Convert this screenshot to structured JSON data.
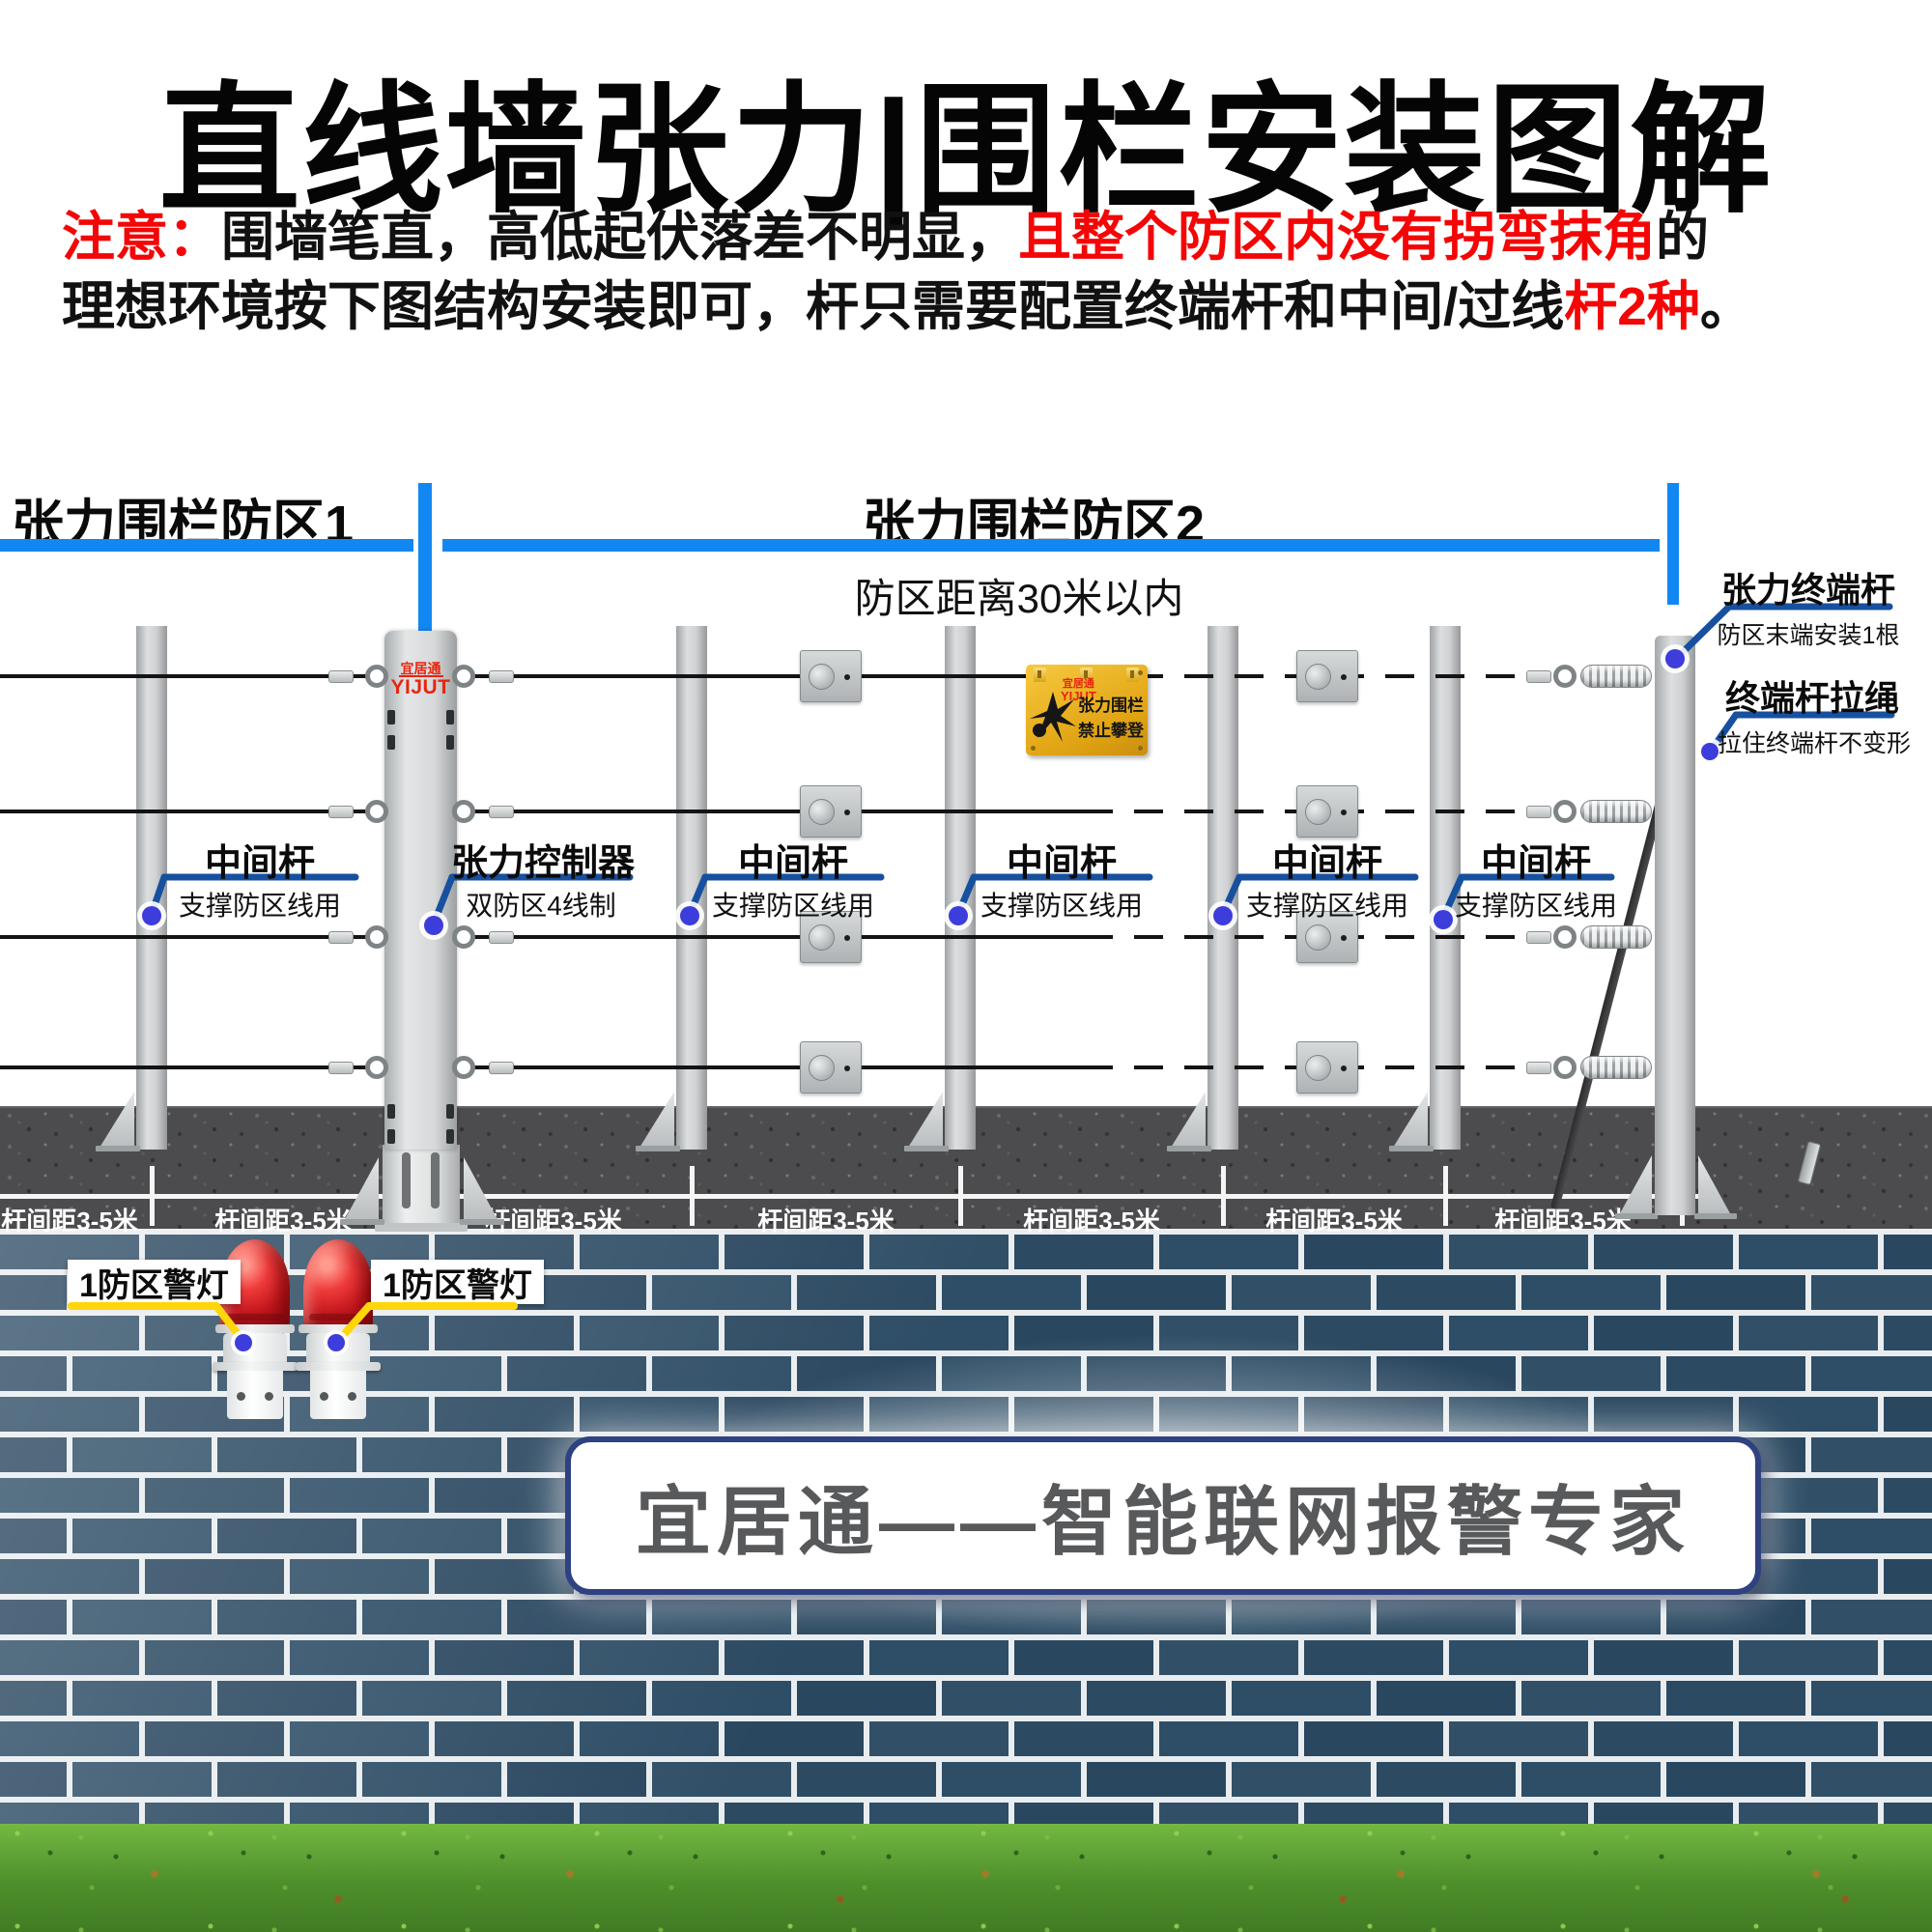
{
  "title": "直线墙张力|围栏安装图解",
  "note": {
    "prefix": "注意：",
    "l1_black1": "围墙笔直，高低起伏落差不明显，",
    "l1_red": "且整个防区内没有拐弯抹角",
    "l1_black2": "的",
    "l2_black1": "理想环境按下图结构安装即可，杆只需要配置终端杆和中间/过线",
    "l2_red": "杆2种",
    "l2_black2": "。"
  },
  "zones": {
    "zone1": "张力围栏防区1",
    "zone2": "张力围栏防区2",
    "distance": "防区距离30米以内"
  },
  "callouts": [
    {
      "title": "中间杆",
      "sub": "支撑防区线用"
    },
    {
      "title": "张力控制器",
      "sub": "双防区4线制"
    },
    {
      "title": "中间杆",
      "sub": "支撑防区线用"
    },
    {
      "title": "中间杆",
      "sub": "支撑防区线用"
    },
    {
      "title": "中间杆",
      "sub": "支撑防区线用"
    },
    {
      "title": "中间杆",
      "sub": "支撑防区线用"
    },
    {
      "title": "张力终端杆",
      "sub": "防区末端安装1根"
    },
    {
      "title": "终端杆拉绳",
      "sub": "拉住终端杆不变形"
    }
  ],
  "controller_logo": {
    "cn": "宜居通",
    "en": "YIJUT"
  },
  "sign": {
    "logo_cn": "宜居通",
    "logo_en": "YIJUT",
    "line1": "张力围栏",
    "line2": "禁止攀登"
  },
  "ground": {
    "labels": [
      "杆间距3-5米",
      "杆间距3-5米",
      "杆间距3-5米",
      "杆间距3-5米",
      "杆间距3-5米",
      "杆间距3-5米",
      "杆间距3-5米"
    ]
  },
  "lamps": {
    "labels": [
      "1防区警灯",
      "1防区警灯"
    ]
  },
  "banner": {
    "text": "宜居通——智能联网报警专家"
  },
  "colors": {
    "zone_bar": "#1287f2",
    "callout_line": "#17509f",
    "callout_dot": "#3d3ddb",
    "lamp_line": "#ffd60a",
    "brick": "#2d4b63",
    "sign_yellow": "#edb21d",
    "alert_red": "#f40606"
  }
}
